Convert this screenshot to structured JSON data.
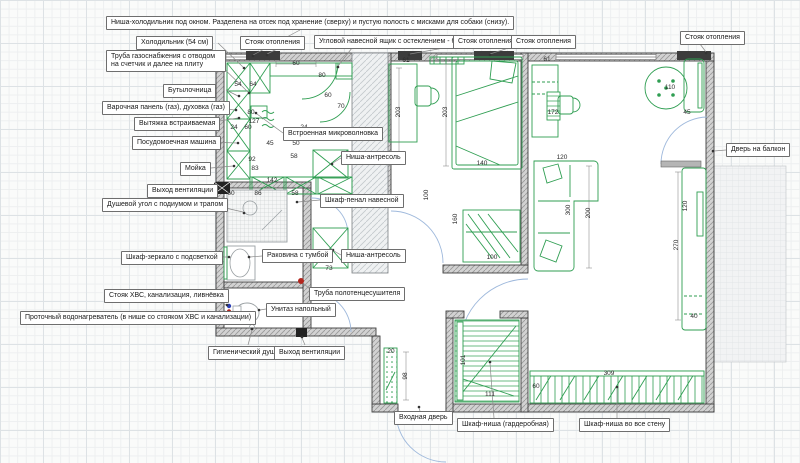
{
  "drawing": {
    "title_note": "Annotated apartment floor plan",
    "colors": {
      "furniture_green": "#2f9e52",
      "wall_dark": "#3e3e3e",
      "wall_fill": "#d2d2d2",
      "door_arc_blue": "#9fb9dc",
      "hot_water_red": "#b3261e",
      "cold_water_blue": "#2b3fb5",
      "label_border": "#6e6e6e",
      "grid_line": "#dde2e5"
    },
    "callouts": [
      {
        "id": "fridge-niche-note",
        "text": "Ниша-холодильник под окном. Разделена на отсек под хранение (сверху) и пустую полость с мисками для собаки (снизу).",
        "x": 106,
        "y": 16
      },
      {
        "id": "fridge",
        "text": "Холодильник (54 см)",
        "x": 136,
        "y": 36
      },
      {
        "id": "heating-riser-1",
        "text": "Стояк отопления",
        "x": 240,
        "y": 36
      },
      {
        "id": "corner-buffet",
        "text": "Угловой навесной ящик с остеклением - буфет",
        "x": 314,
        "y": 35
      },
      {
        "id": "heating-riser-2",
        "text": "Стояк отопления",
        "x": 453,
        "y": 35
      },
      {
        "id": "heating-riser-3",
        "text": "Стояк отопления",
        "x": 511,
        "y": 35
      },
      {
        "id": "heating-riser-4",
        "text": "Стояк отопления",
        "x": 680,
        "y": 31
      },
      {
        "id": "gas-pipe",
        "text": "Труба газоснабжения с отводом на счетчик и далее на плиту",
        "x": 106,
        "y": 50,
        "w": 110
      },
      {
        "id": "bottle-rack",
        "text": "Бутылочница",
        "x": 163,
        "y": 84
      },
      {
        "id": "hob-oven",
        "text": "Варочная панель (газ), духовка (газ)",
        "x": 102,
        "y": 101
      },
      {
        "id": "hood",
        "text": "Вытяжка встраиваемая",
        "x": 134,
        "y": 117
      },
      {
        "id": "dishwasher",
        "text": "Посудомоечная машина",
        "x": 132,
        "y": 136
      },
      {
        "id": "kitchen-sink",
        "text": "Мойка",
        "x": 180,
        "y": 162
      },
      {
        "id": "vent-outlet-1",
        "text": "Выход вентиляции",
        "x": 147,
        "y": 184
      },
      {
        "id": "shower-corner",
        "text": "Душевой угол с подиумом и трапом",
        "x": 102,
        "y": 198
      },
      {
        "id": "mirror-cabinet",
        "text": "Шкаф-зеркало с подсветкой",
        "x": 121,
        "y": 251
      },
      {
        "id": "water-riser",
        "text": "Стояк ХВС, канализация, ливнёвка",
        "x": 104,
        "y": 289
      },
      {
        "id": "water-heater",
        "text": "Проточный водонагреватель (в нише со стояком ХВС и канализации)",
        "x": 20,
        "y": 311
      },
      {
        "id": "hygienic-shower",
        "text": "Гигиенический душ",
        "x": 208,
        "y": 346
      },
      {
        "id": "vent-outlet-2",
        "text": "Выход вентиляции",
        "x": 274,
        "y": 346
      },
      {
        "id": "built-in-microwave",
        "text": "Встроенная микроволновка",
        "x": 283,
        "y": 127
      },
      {
        "id": "mezzanine-niche-1",
        "text": "Ниша-антресоль",
        "x": 341,
        "y": 151
      },
      {
        "id": "tall-wall-cabinet",
        "text": "Шкаф-пенал навесной",
        "x": 320,
        "y": 194
      },
      {
        "id": "vanity-sink",
        "text": "Раковина с тумбой",
        "x": 262,
        "y": 249
      },
      {
        "id": "mezzanine-niche-2",
        "text": "Ниша-антресоль",
        "x": 341,
        "y": 249
      },
      {
        "id": "towel-dryer-pipe",
        "text": "Труба полотенцесушителя",
        "x": 309,
        "y": 287
      },
      {
        "id": "floor-toilet",
        "text": "Унитаз напольный",
        "x": 266,
        "y": 303
      },
      {
        "id": "entry-door",
        "text": "Входная дверь",
        "x": 394,
        "y": 411
      },
      {
        "id": "wardrobe-niche",
        "text": "Шкаф-ниша (гардеробная)",
        "x": 457,
        "y": 418
      },
      {
        "id": "full-wall-closet",
        "text": "Шкаф-ниша во все стену",
        "x": 579,
        "y": 418
      },
      {
        "id": "balcony-door",
        "text": "Дверь на балкон",
        "x": 726,
        "y": 143
      }
    ],
    "dimensions": [
      {
        "v": "60",
        "x": 296,
        "y": 64,
        "rot": 0
      },
      {
        "v": "54",
        "x": 238,
        "y": 85,
        "rot": 0
      },
      {
        "v": "64",
        "x": 253,
        "y": 85,
        "rot": 0
      },
      {
        "v": "80",
        "x": 322,
        "y": 76,
        "rot": 0
      },
      {
        "v": "60",
        "x": 328,
        "y": 96,
        "rot": 0
      },
      {
        "v": "70",
        "x": 341,
        "y": 107,
        "rot": 0
      },
      {
        "v": "80",
        "x": 251,
        "y": 113,
        "rot": 0
      },
      {
        "v": "127",
        "x": 254,
        "y": 122,
        "rot": 0
      },
      {
        "v": "24",
        "x": 234,
        "y": 128,
        "rot": 0
      },
      {
        "v": "60",
        "x": 248,
        "y": 128,
        "rot": 0
      },
      {
        "v": "24",
        "x": 304,
        "y": 128,
        "rot": 0
      },
      {
        "v": "45",
        "x": 270,
        "y": 144,
        "rot": 0
      },
      {
        "v": "50",
        "x": 296,
        "y": 144,
        "rot": 0
      },
      {
        "v": "58",
        "x": 294,
        "y": 157,
        "rot": 0
      },
      {
        "v": "92",
        "x": 252,
        "y": 160,
        "rot": 0
      },
      {
        "v": "83",
        "x": 255,
        "y": 169,
        "rot": 0
      },
      {
        "v": "142",
        "x": 272,
        "y": 181,
        "rot": 0
      },
      {
        "v": "60",
        "x": 231,
        "y": 194,
        "rot": 0
      },
      {
        "v": "86",
        "x": 258,
        "y": 194,
        "rot": 0
      },
      {
        "v": "58",
        "x": 295,
        "y": 194,
        "rot": 0
      },
      {
        "v": "73",
        "x": 329,
        "y": 269,
        "rot": 0
      },
      {
        "v": "61",
        "x": 406,
        "y": 61,
        "rot": 0
      },
      {
        "v": "203",
        "x": 399,
        "y": 112,
        "rot": 1
      },
      {
        "v": "203",
        "x": 446,
        "y": 112,
        "rot": 1
      },
      {
        "v": "140",
        "x": 482,
        "y": 164,
        "rot": 0
      },
      {
        "v": "100",
        "x": 427,
        "y": 195,
        "rot": 1
      },
      {
        "v": "160",
        "x": 456,
        "y": 219,
        "rot": 1
      },
      {
        "v": "100",
        "x": 492,
        "y": 258,
        "rot": 0
      },
      {
        "v": "61",
        "x": 547,
        "y": 60,
        "rot": 0
      },
      {
        "v": "172",
        "x": 553,
        "y": 113,
        "rot": 0
      },
      {
        "v": "110",
        "x": 670,
        "y": 88,
        "rot": 0
      },
      {
        "v": "45",
        "x": 687,
        "y": 113,
        "rot": 0
      },
      {
        "v": "120",
        "x": 562,
        "y": 158,
        "rot": 0
      },
      {
        "v": "200",
        "x": 589,
        "y": 213,
        "rot": 1
      },
      {
        "v": "300",
        "x": 569,
        "y": 210,
        "rot": 1
      },
      {
        "v": "120",
        "x": 686,
        "y": 206,
        "rot": 1
      },
      {
        "v": "270",
        "x": 677,
        "y": 245,
        "rot": 1
      },
      {
        "v": "40",
        "x": 694,
        "y": 317,
        "rot": 0
      },
      {
        "v": "20",
        "x": 391,
        "y": 352,
        "rot": 0
      },
      {
        "v": "98",
        "x": 406,
        "y": 376,
        "rot": 1
      },
      {
        "v": "101",
        "x": 464,
        "y": 360,
        "rot": 1
      },
      {
        "v": "111",
        "x": 490,
        "y": 395,
        "rot": 0
      },
      {
        "v": "309",
        "x": 609,
        "y": 374,
        "rot": 0
      },
      {
        "v": "60",
        "x": 536,
        "y": 387,
        "rot": 0
      }
    ]
  }
}
